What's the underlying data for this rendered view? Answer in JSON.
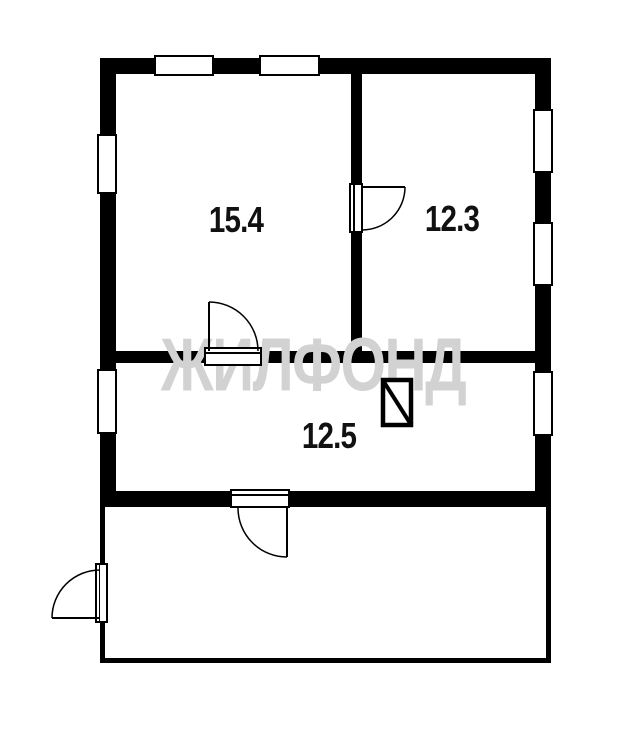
{
  "watermark": {
    "text": "ЖИЛФОНД",
    "color": "#d2d2d2"
  },
  "rooms": [
    {
      "id": "room-top-left",
      "area_label": "15.4"
    },
    {
      "id": "room-top-right",
      "area_label": "12.3"
    },
    {
      "id": "room-bottom",
      "area_label": "12.5"
    }
  ],
  "symbols": [
    {
      "name": "stove-icon",
      "description": "rectangle with diagonal line"
    }
  ],
  "colors": {
    "wall": "#000000",
    "background": "#ffffff",
    "label": "#111111",
    "watermark": "#d2d2d2"
  }
}
